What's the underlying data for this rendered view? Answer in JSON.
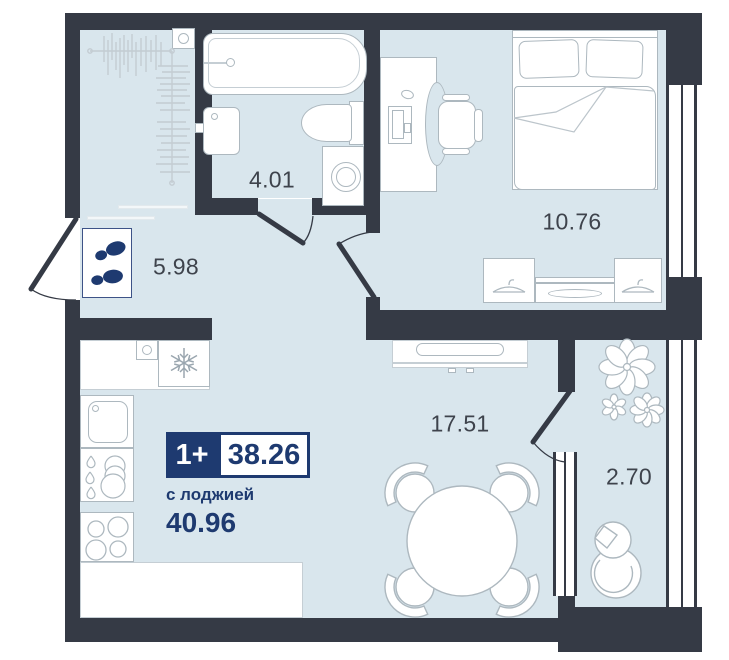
{
  "plan": {
    "badge": {
      "room_type": "1+",
      "area_main": "38.26",
      "area_note": "с лоджией",
      "area_total": "40.96"
    },
    "rooms": {
      "bathroom": {
        "area": "4.01"
      },
      "bedroom": {
        "area": "10.76"
      },
      "hallway": {
        "area": "5.98"
      },
      "living_kitchen": {
        "area": "17.51"
      },
      "balcony": {
        "area": "2.70"
      }
    },
    "colors": {
      "wall": "#353a45",
      "floor": "#d9e6ed",
      "accent": "#1e3a70",
      "outline": "#adb8bf",
      "label": "#3e434c"
    }
  }
}
